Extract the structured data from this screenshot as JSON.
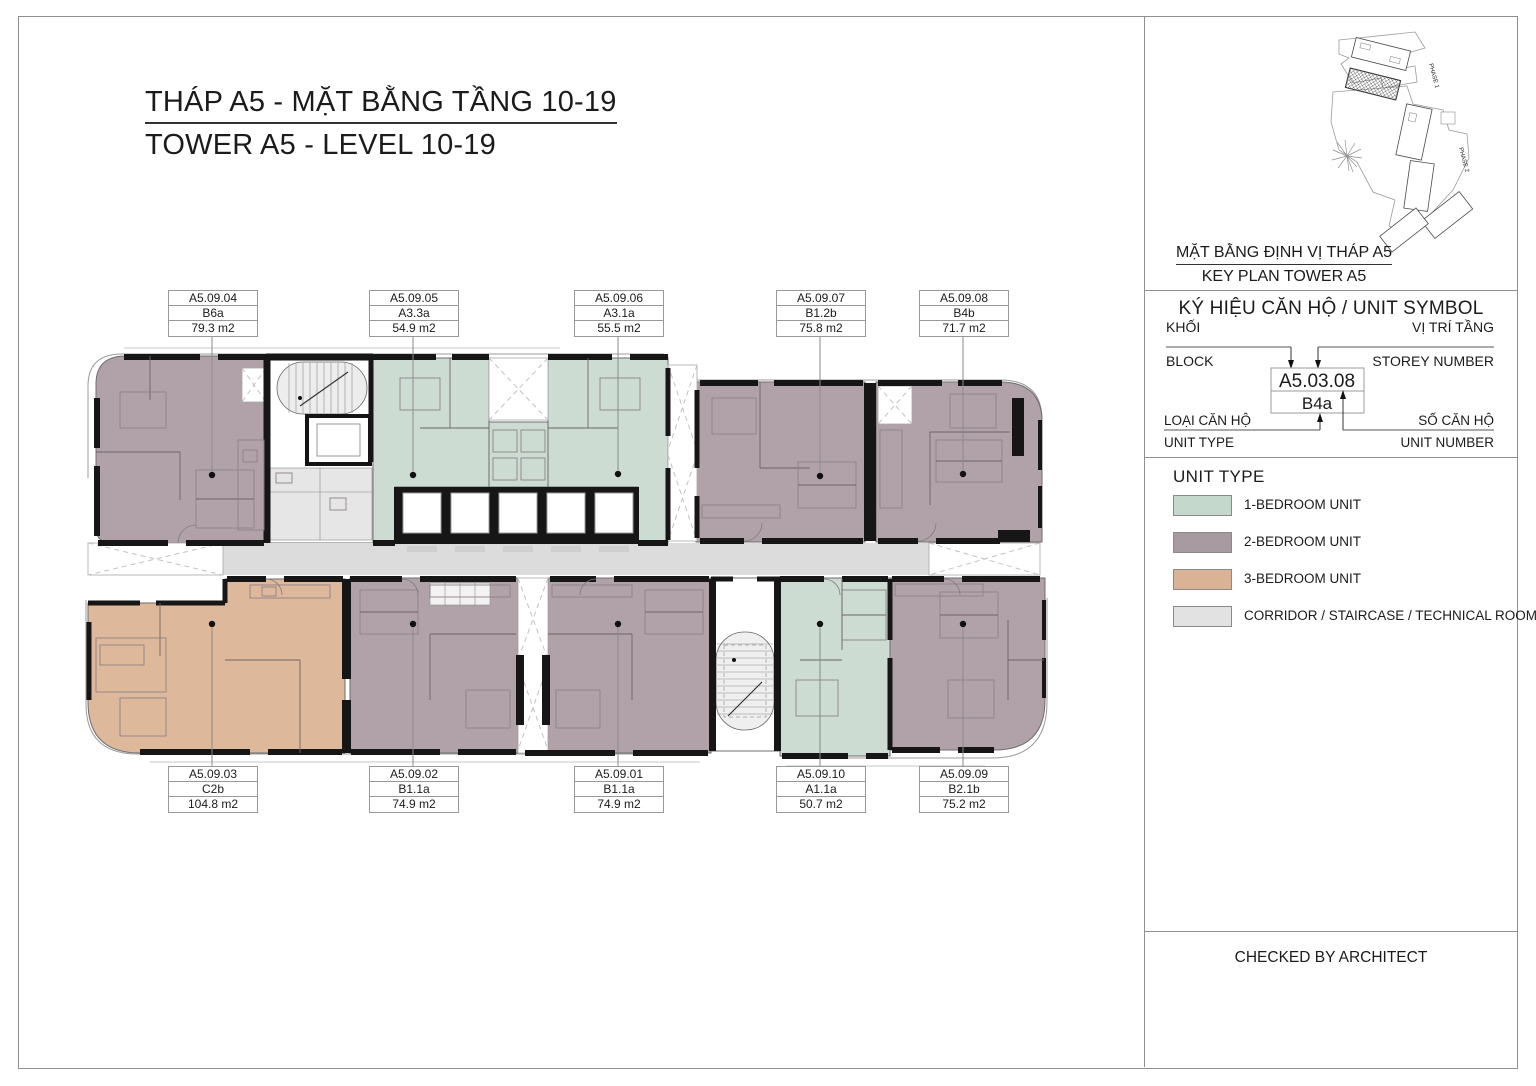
{
  "title": {
    "line1_vi": "THÁP A5 - MẶT BẰNG TẦNG 10-19",
    "line2_en": "TOWER A5 - LEVEL 10-19"
  },
  "plan": {
    "units": [
      {
        "code": "A5.09.04",
        "type": "B6a",
        "area": "79.3 m2",
        "unit_type": "2-bedroom"
      },
      {
        "code": "A5.09.05",
        "type": "A3.3a",
        "area": "54.9 m2",
        "unit_type": "1-bedroom"
      },
      {
        "code": "A5.09.06",
        "type": "A3.1a",
        "area": "55.5 m2",
        "unit_type": "1-bedroom"
      },
      {
        "code": "A5.09.07",
        "type": "B1.2b",
        "area": "75.8 m2",
        "unit_type": "2-bedroom"
      },
      {
        "code": "A5.09.08",
        "type": "B4b",
        "area": "71.7 m2",
        "unit_type": "2-bedroom"
      },
      {
        "code": "A5.09.03",
        "type": "C2b",
        "area": "104.8 m2",
        "unit_type": "3-bedroom"
      },
      {
        "code": "A5.09.02",
        "type": "B1.1a",
        "area": "74.9 m2",
        "unit_type": "2-bedroom"
      },
      {
        "code": "A5.09.01",
        "type": "B1.1a",
        "area": "74.9 m2",
        "unit_type": "2-bedroom"
      },
      {
        "code": "A5.09.10",
        "type": "A1.1a",
        "area": "50.7 m2",
        "unit_type": "1-bedroom"
      },
      {
        "code": "A5.09.09",
        "type": "B2.1b",
        "area": "75.2 m2",
        "unit_type": "2-bedroom"
      }
    ],
    "colors": {
      "one_bed": "#cddcd3",
      "two_bed": "#b1a2a9",
      "three_bed": "#deb89b",
      "corridor": "#dcdcdc"
    }
  },
  "sidebar": {
    "key_plan": {
      "caption_vi": "MẶT BẰNG ĐỊNH VỊ THÁP A5",
      "caption_en": "KEY PLAN TOWER A5",
      "phase1": "PHASE 1",
      "phase2": "PHASE 2"
    },
    "unit_symbol": {
      "heading": "KÝ HIỆU CĂN HỘ / UNIT SYMBOL",
      "block_vi": "KHỐI",
      "block_en": "BLOCK",
      "storey_vi": "VỊ TRÍ TẦNG",
      "storey_en": "STOREY NUMBER",
      "unit_type_vi": "LOẠI CĂN HỘ",
      "unit_type_en": "UNIT TYPE",
      "unit_number_vi": "SỐ CĂN HỘ",
      "unit_number_en": "UNIT NUMBER",
      "example_code": "A5.03.08",
      "example_type": "B4a"
    },
    "unit_type_legend": {
      "heading": "UNIT TYPE",
      "items": [
        {
          "label": "1-BEDROOM UNIT",
          "color": "#c4d8cc"
        },
        {
          "label": "2-BEDROOM UNIT",
          "color": "#a89aa1"
        },
        {
          "label": "3-BEDROOM UNIT",
          "color": "#dab295"
        },
        {
          "label": "CORRIDOR / STAIRCASE / TECHNICAL ROOM",
          "color": "#e2e2e2"
        }
      ]
    },
    "footer": {
      "checked_by": "CHECKED BY ARCHITECT"
    }
  }
}
